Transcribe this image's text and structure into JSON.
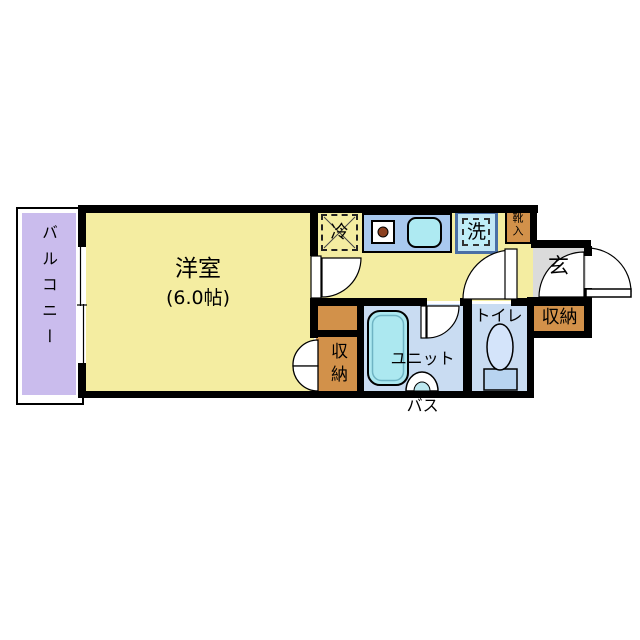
{
  "plan": {
    "balcony": {
      "label": "バルコニー"
    },
    "room": {
      "label": "洋室",
      "size": "(6.0帖)"
    },
    "kitchen": {
      "fridge_label": "冷",
      "washer_label": "洗",
      "shoe_box_label": "靴入"
    },
    "entrance": {
      "label": "玄"
    },
    "unit_bath": {
      "label_line1": "ユニット",
      "label_line2": "バス"
    },
    "toilet": {
      "label": "トイレ"
    },
    "closet_room": {
      "label": "収納"
    },
    "closet_entrance": {
      "label": "収納"
    },
    "colors": {
      "wall": "#000000",
      "room_yellow": "#f4eda1",
      "balcony_purple": "#cabced",
      "closet_orange": "#d2914a",
      "entrance_gray": "#dbdbdb",
      "wet_area_blue": "#c9dcf2",
      "counter_blue": "#a9c9ef",
      "fixture_cyan": "#aeeaf2"
    }
  }
}
